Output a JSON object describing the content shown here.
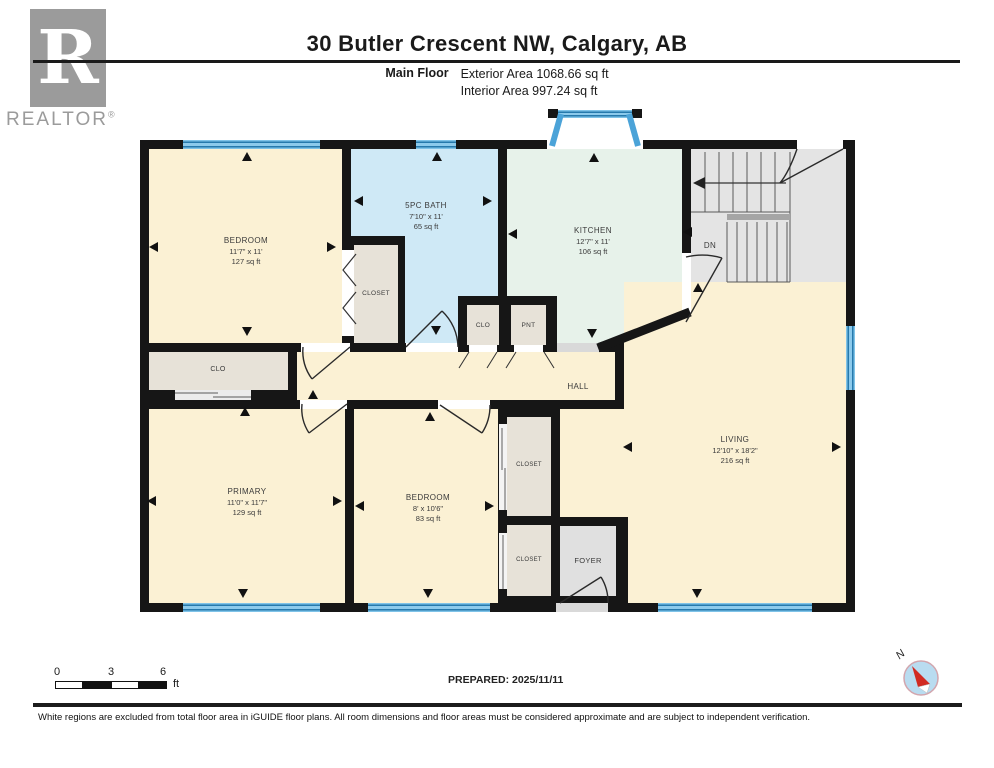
{
  "header": {
    "title": "30 Butler Crescent NW, Calgary, AB",
    "floor_label": "Main Floor",
    "exterior_area": "Exterior Area 1068.66 sq ft",
    "interior_area": "Interior Area 997.24 sq ft"
  },
  "logo": {
    "letter": "R",
    "brand": "REALTOR",
    "registered": "®"
  },
  "plan": {
    "rooms": {
      "bedroom1": {
        "name": "BEDROOM",
        "dims": "11'7\" x 11'",
        "area": "127 sq ft"
      },
      "bath": {
        "name": "5PC BATH",
        "dims": "7'10\" x 11'",
        "area": "65 sq ft"
      },
      "kitchen": {
        "name": "KITCHEN",
        "dims": "12'7\" x 11'",
        "area": "106 sq ft"
      },
      "living": {
        "name": "LIVING",
        "dims": "12'10\" x 18'2\"",
        "area": "216 sq ft"
      },
      "primary": {
        "name": "PRIMARY",
        "dims": "11'0\" x 11'7\"",
        "area": "129 sq ft"
      },
      "bedroom2": {
        "name": "BEDROOM",
        "dims": "8' x 10'6\"",
        "area": "83 sq ft"
      },
      "hall": {
        "name": "HALL"
      },
      "closet_bedroom1": {
        "name": "CLOSET"
      },
      "closet_hall": {
        "name": "CLO"
      },
      "closet_hall_small": {
        "name": "CLO"
      },
      "pantry": {
        "name": "PNT"
      },
      "closet_bed2_upper": {
        "name": "CLOSET"
      },
      "closet_bed2_lower": {
        "name": "CLOSET"
      },
      "foyer": {
        "name": "FOYER"
      },
      "stairs": {
        "down_label": "DN"
      }
    }
  },
  "scale_bar": {
    "ticks": [
      "0",
      "3",
      "6"
    ],
    "unit": "ft"
  },
  "compass": {
    "north_label": "N"
  },
  "footer": {
    "prepared": "PREPARED: 2025/11/11",
    "disclaimer": "White regions are excluded from total floor area in iGUIDE floor plans. All room dimensions and floor areas must be considered approximate and are subject to independent verification."
  },
  "colors": {
    "wall": "#161616",
    "room_cream": "#fbf1d4",
    "bath_blue": "#cfe9f6",
    "kitchen_mint": "#e7f2ea",
    "closet_beige": "#e7e2d8",
    "stairs_gray": "#e4e4e4",
    "window_blue": "#4ba3d8"
  }
}
